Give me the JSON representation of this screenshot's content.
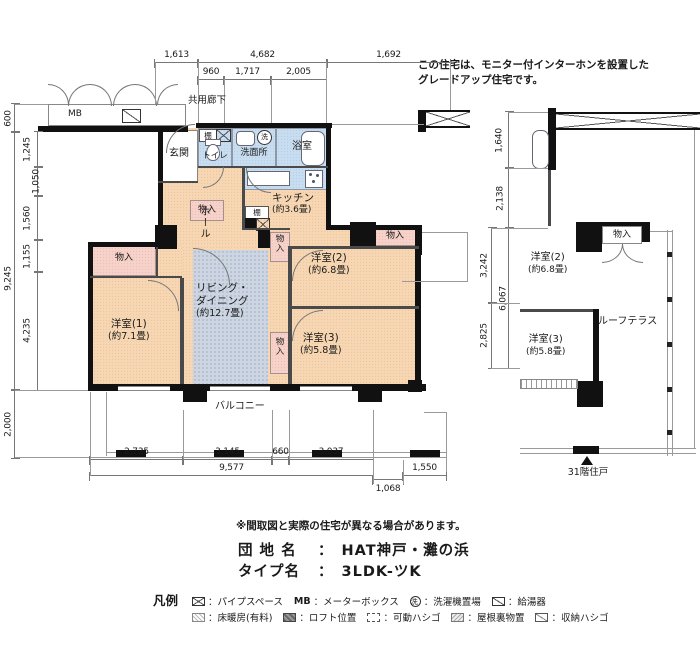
{
  "note": {
    "line1": "この住宅は、モニター付インターホンを設置した",
    "line2": "グレードアップ住宅です。"
  },
  "labels": {
    "corridor": "共用廊下",
    "mb": "MB",
    "genkan": "玄関",
    "toilet": "トイレ",
    "washroom": "洗面所",
    "bath": "浴室",
    "kitchen": "キッチン",
    "kitchen_size": "(約3.6畳)",
    "hall": "ホール",
    "living_line1": "リビング・",
    "living_line2": "ダイニング",
    "living_size": "(約12.7畳)",
    "bed1": "洋室(1)",
    "bed1_size": "(約7.1畳)",
    "bed2": "洋室(2)",
    "bed2_size": "(約6.8畳)",
    "bed3": "洋室(3)",
    "bed3_size": "(約5.8畳)",
    "balcony": "バルコニー",
    "storage": "物入",
    "shelf": "棚",
    "roof_terrace": "ルーフテラス",
    "floor_note": "31階住戸",
    "laundry": "洗"
  },
  "dims": {
    "top_row1": [
      "1,613",
      "4,682",
      "1,692"
    ],
    "top_row2": [
      "960",
      "1,717",
      "2,005"
    ],
    "left_outer": [
      "600",
      "9,245",
      "2,000"
    ],
    "left_inner": [
      "1,245",
      "1,050",
      "1,560",
      "1,155",
      "4,235"
    ],
    "bottom_row1": [
      "2,735",
      "3,145",
      "660",
      "3,037"
    ],
    "bottom_total": "9,577",
    "bottom_right": "1,550",
    "bottom_offset": "1,068",
    "right_col": [
      "1,640",
      "2,138",
      "3,242",
      "6,067",
      "2,825"
    ]
  },
  "footer": {
    "disclaimer": "※間取図と実際の住宅が異なる場合があります。",
    "estate_label": "団 地 名",
    "estate_colon": "：",
    "estate_value": "HAT神戸・灘の浜",
    "type_label": "タイプ名",
    "type_colon": "：",
    "type_value": "3LDK-ツK"
  },
  "legend": {
    "title": "凡例",
    "mb_prefix": "MB",
    "laundry_char": "洗",
    "row1": [
      {
        "name": "pipe-space",
        "label": "：パイプスペース"
      },
      {
        "name": "meter-box",
        "label": "：メーターボックス"
      },
      {
        "name": "laundry",
        "label": "：洗濯機置場"
      },
      {
        "name": "water-heater",
        "label": "：給湯器"
      }
    ],
    "row2": [
      {
        "name": "floor-heating",
        "label": "：床暖房(有料)"
      },
      {
        "name": "loft",
        "label": "：ロフト位置"
      },
      {
        "name": "movable-ladder",
        "label": "：可動ハシゴ"
      },
      {
        "name": "attic-storage",
        "label": "：屋根裏物置"
      },
      {
        "name": "storage-ladder",
        "label": "：収納ハシゴ"
      }
    ]
  },
  "colors": {
    "room": "#f7d7b3",
    "water": "#c9ddf0",
    "closet": "#f6d2ca",
    "floor_heating": "#ccd5e1",
    "wall": "#111111"
  }
}
